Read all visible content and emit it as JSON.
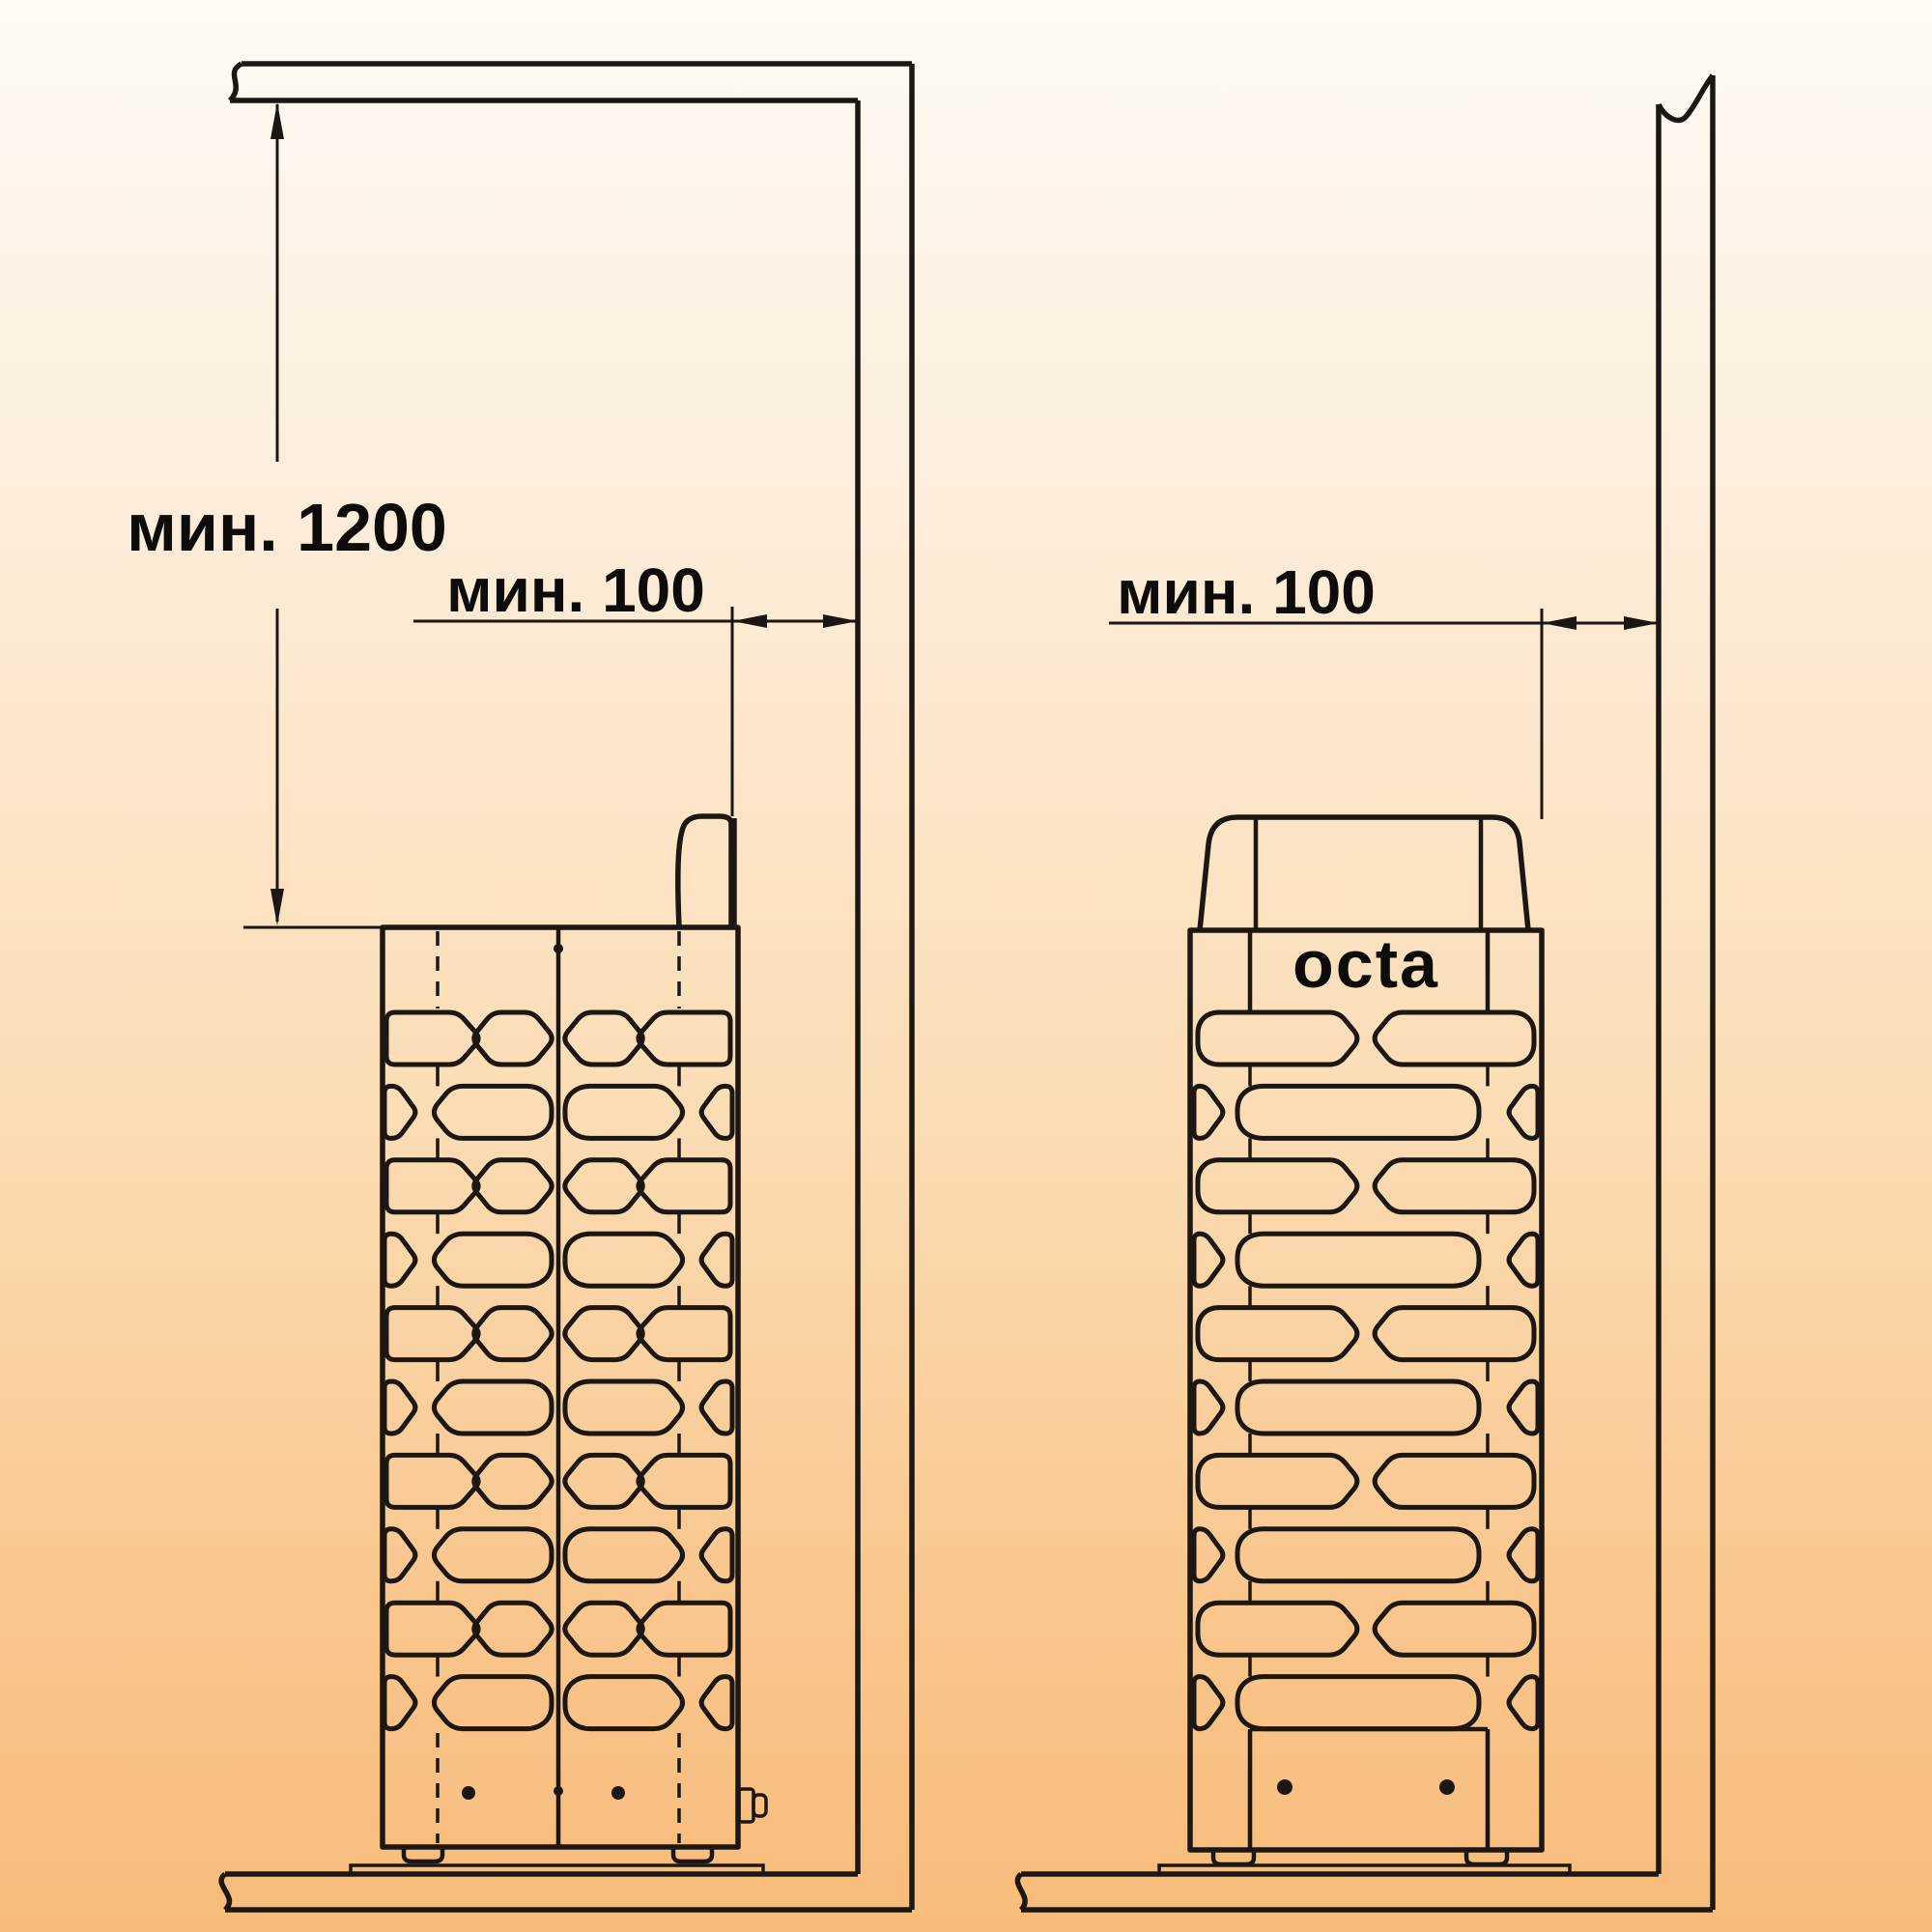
{
  "dimensions": {
    "min_ceiling_clearance": "мин. 1200",
    "min_wall_gap_left_view": "мин. 100",
    "min_wall_gap_right_view": "мин. 100"
  },
  "brand": {
    "logo_text": "octa"
  },
  "colors": {
    "line": "#1c1713",
    "text": "#0e0c0a",
    "bg_top": "#fdfaf4",
    "bg_mid": "#fbdcb4",
    "bg_bottom": "#f8bb7a"
  }
}
